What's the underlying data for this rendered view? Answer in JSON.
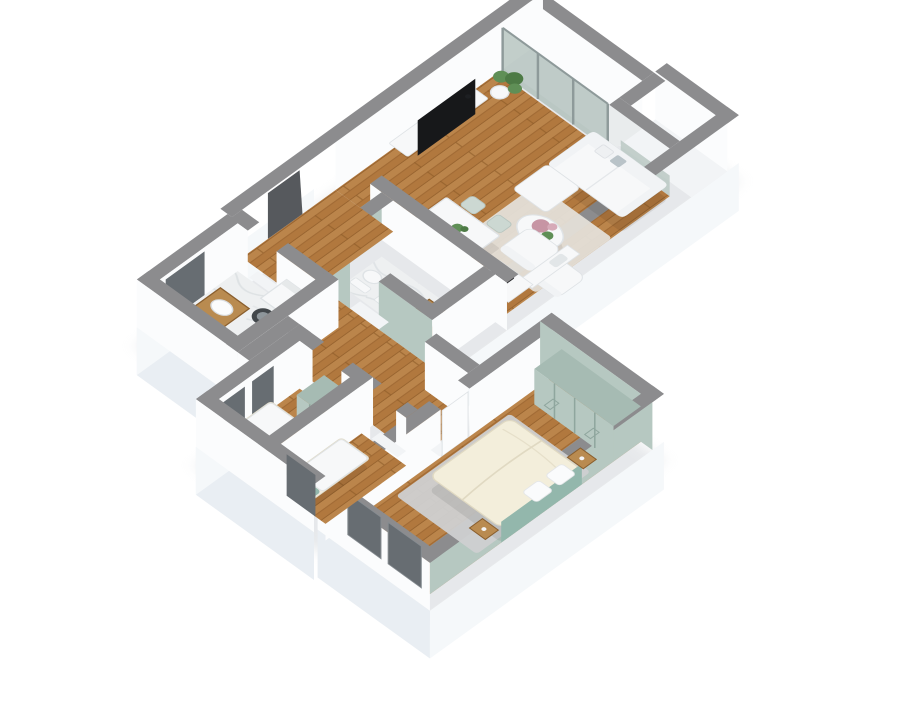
{
  "meta": {
    "description": "3D isometric rendering of a furnished apartment floor plan on a white background",
    "render_style": "cutaway 3d floorplan, walls cut at waist height with gray tops"
  },
  "colors": {
    "background": "#ffffff",
    "shadow": "#c2c8ce",
    "wall_top": "#8c8c8e",
    "wall_face": "#fbfcfd",
    "wall_face_shade": "#f1f3f5",
    "ext_face": "#f5f8fa",
    "ext_face_shade": "#e9eef3",
    "wood": "#b1783e",
    "wood_light": "#c9955a",
    "wood_dark": "#8f5d2a",
    "marble": "#eef0f1",
    "marble_vein": "#d9dee1",
    "balcony_floor": "#e9eced",
    "ledge": "#f2f4f6",
    "glass": "#b7c5c1",
    "glass_frame": "#8e9a9a",
    "sage": "#b6c8c1",
    "sage_dark": "#a6bbb3",
    "sage_line": "#8fa69e",
    "teal": "#93b7ac",
    "cream": "#f3eedb",
    "cream_line": "#e0d9c2",
    "rug_living": "#e4dfd8",
    "rug_master": "#cfd0d1",
    "white_furn": "#f7f8f9",
    "furn_stroke": "#dfe3e6",
    "wood_furn": "#b98b50",
    "wood_furn_dark": "#8a5f2e",
    "dark_window": "#676d72",
    "door_dark": "#56595d",
    "tv": "#17181a",
    "cooktop": "#202225",
    "burner": "#4a4e52",
    "plant": "#5f8f56",
    "plant_dark": "#4d7a45",
    "flower": "#c795a4",
    "flower_light": "#d6aab8",
    "chair": "#ccd8d2",
    "chair_stroke": "#b7c5bf",
    "washer_door": "#42474b",
    "washer_ring": "#8e969b"
  },
  "scene": {
    "rooms": [
      {
        "id": "balcony",
        "floor": "light-gray",
        "features": [
          "sliding-glass-doors",
          "parapet-wall",
          "side-ledge"
        ]
      },
      {
        "id": "living-room",
        "floor": "wood",
        "furniture": [
          "tv-stand",
          "flat-tv",
          "potted-plant",
          "sofa-with-chaise",
          "throw-pillows",
          "round-coffee-table",
          "flower-bouquet",
          "area-rug",
          "armchair",
          "ottoman-chair",
          "dining-table",
          "table-plant",
          "dining-chairs"
        ]
      },
      {
        "id": "kitchen",
        "floor": "wood",
        "furniture": [
          "counter",
          "cooktop",
          "sink"
        ]
      },
      {
        "id": "bathroom",
        "floor": "marble",
        "furniture": [
          "wall-hung-toilet",
          "bidet",
          "wood-vanity-with-sink"
        ],
        "accent": "sage-walls"
      },
      {
        "id": "hallway",
        "floor": "wood",
        "features": [
          "entrance-door",
          "door-openings"
        ]
      },
      {
        "id": "laundry-room",
        "floor": "marble",
        "furniture": [
          "washing-machine",
          "wood-vanity-with-sink",
          "window"
        ]
      },
      {
        "id": "bedroom-2",
        "floor": "wood",
        "furniture": [
          "single-bed",
          "teal-pillow",
          "sage-wardrobe",
          "windows"
        ]
      },
      {
        "id": "bedroom-3",
        "floor": "wood",
        "furniture": [
          "single-bed",
          "teal-pillow",
          "window"
        ]
      },
      {
        "id": "master-bedroom",
        "floor": "wood",
        "furniture": [
          "double-bed",
          "teal-headboard",
          "pillows",
          "nightstands",
          "sage-wardrobe",
          "area-rug",
          "windows"
        ],
        "accent": "sage-walls"
      }
    ]
  }
}
